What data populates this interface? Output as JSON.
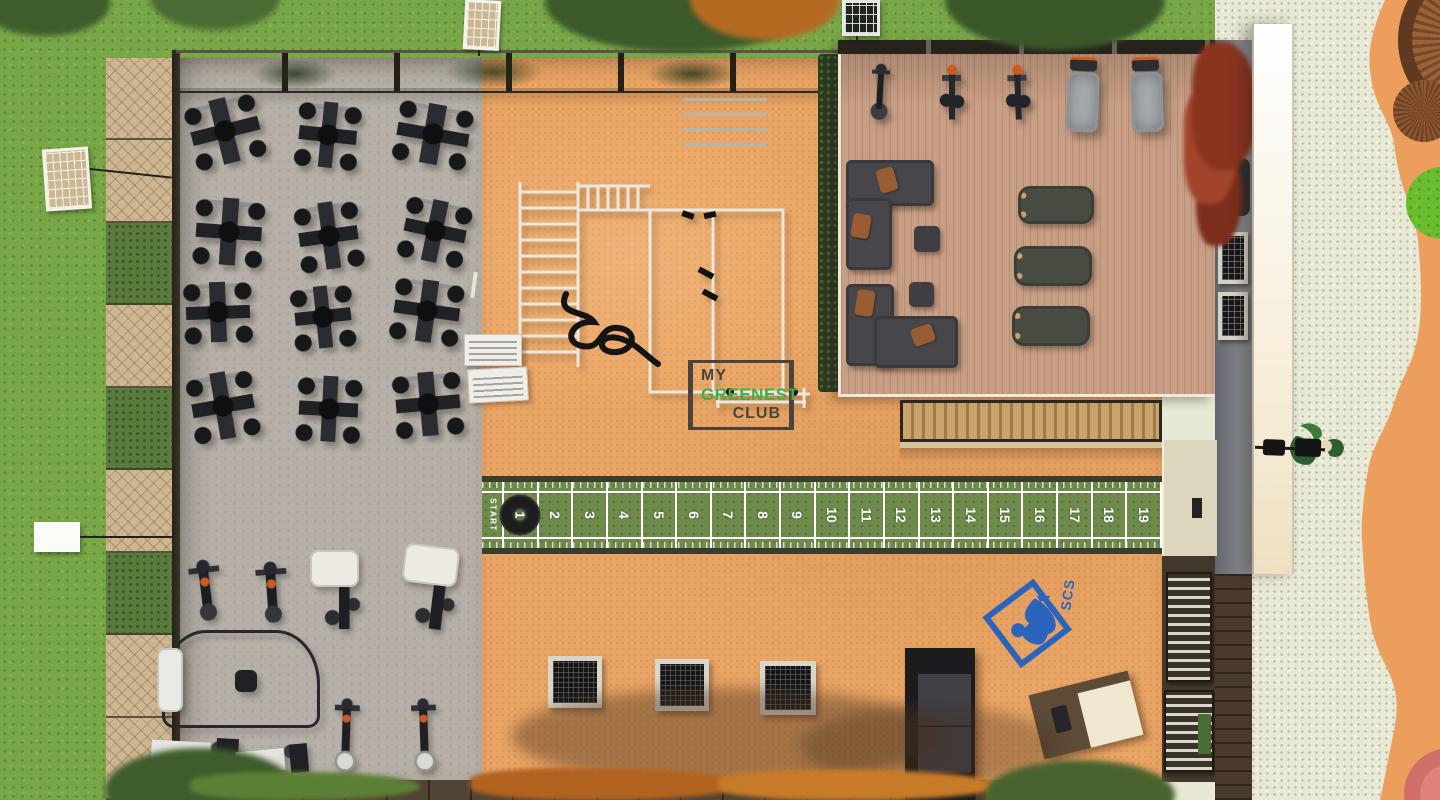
{
  "branding": {
    "club_logo": {
      "line1": "MY",
      "line2": "GREENEST",
      "line3": "CLUB",
      "accent_color": "#3fae49",
      "frame_color": "#4a443c"
    },
    "scs_logo": {
      "text": "SCS",
      "color": "#2b64bd"
    }
  },
  "track": {
    "start_label": "START",
    "markers": [
      "1",
      "2",
      "3",
      "4",
      "5",
      "6",
      "7",
      "8",
      "9",
      "10",
      "11",
      "12",
      "13",
      "14",
      "15",
      "16",
      "17",
      "18",
      "19"
    ],
    "surface_color": "#6f8b4c",
    "border_color": "#3a3d2c",
    "line_color": "#ffffff",
    "start_tire_color": "#1d1d1d"
  },
  "palette": {
    "grass": "#79a748",
    "orange_floor": "#e9a565",
    "gray_floor": "#b6b0a8",
    "deck_wood": "#c89e84",
    "gravel": "#e7e9d5",
    "path_orange": "#ec9e5c",
    "equipment_dark": "#1f2022",
    "sofa_gray": "#47474b",
    "pillow_orange": "#9a5c33",
    "hedge_green": "#5b7a3e",
    "autumn_foliage": "#b2621f"
  }
}
